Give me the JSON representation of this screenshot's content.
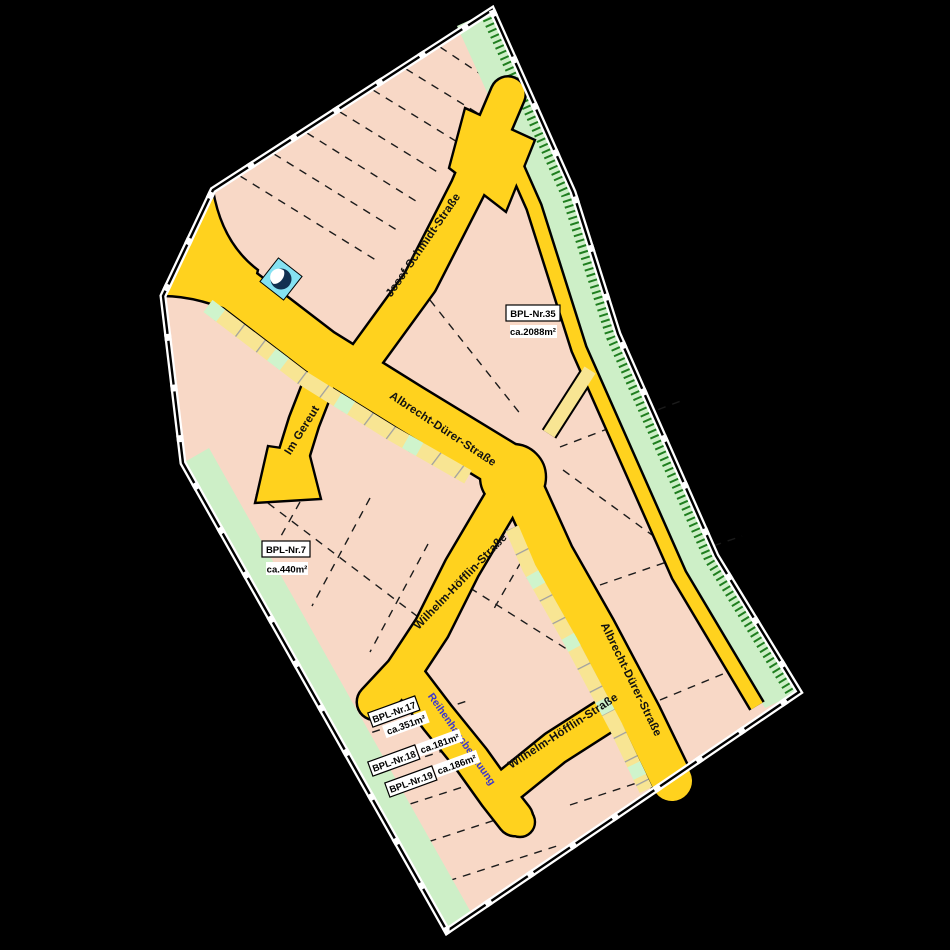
{
  "map": {
    "streets": {
      "josef_schmidt": "Josef-Schmidt-Straße",
      "albrecht_duerer": "Albrecht-Dürer-Straße",
      "wilhelm_hoefflin": "Wilhelm-Höfflin-Straße",
      "im_gereut": "Im Gereut"
    },
    "parcels": {
      "p35": {
        "id": "BPL-Nr.35",
        "area": "ca.2088m²"
      },
      "p7": {
        "id": "BPL-Nr.7",
        "area": "ca.440m²"
      },
      "p17": {
        "id": "BPL-Nr.17",
        "area": "ca.351m²"
      },
      "p18": {
        "id": "BPL-Nr.18",
        "area": "ca.181m²"
      },
      "p19": {
        "id": "BPL-Nr.19",
        "area": "ca.186m²"
      }
    },
    "annotations": {
      "row_housing": "Reihenhausbebauung"
    },
    "colors": {
      "background": "#000000",
      "parcel_pink": "#F8D8C6",
      "road_gold": "#FFD21E",
      "path_yellow": "#F8E593",
      "green_strip": "#CDEFC7",
      "hatch_green": "#1F7E1F",
      "tree_cell": "#CFF4CC",
      "annotation_blue": "#3A35D1",
      "utility_cyan": "#85E2F2",
      "utility_navy": "#123050"
    }
  }
}
